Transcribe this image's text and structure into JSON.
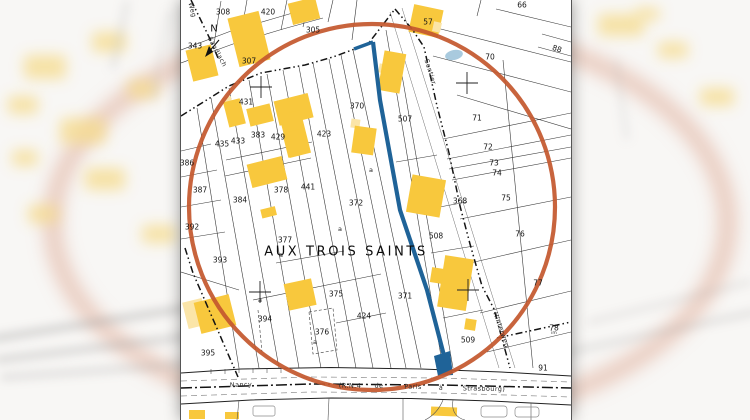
{
  "map": {
    "title": "AUX TROIS SAINTS",
    "north_label": "N",
    "colors": {
      "highlight": "#c4582e",
      "route": "#1f6398",
      "building": "#f8c83d",
      "building_light": "#fbe5a8",
      "pond": "#a9cade",
      "line": "#3a3a3a",
      "paper": "#ffffff"
    },
    "parcel_labels": [
      {
        "text": "308",
        "x": 42,
        "y": 12
      },
      {
        "text": "420",
        "x": 87,
        "y": 12
      },
      {
        "text": "305",
        "x": 132,
        "y": 30
      },
      {
        "text": "57",
        "x": 247,
        "y": 22
      },
      {
        "text": "66",
        "x": 341,
        "y": 5
      },
      {
        "text": "70",
        "x": 309,
        "y": 57
      },
      {
        "text": "88",
        "x": 376,
        "y": 49,
        "rot": 18
      },
      {
        "text": "343",
        "x": 14,
        "y": 46
      },
      {
        "text": "307",
        "x": 68,
        "y": 61
      },
      {
        "text": "431",
        "x": 65,
        "y": 102
      },
      {
        "text": "435",
        "x": 41,
        "y": 144
      },
      {
        "text": "433",
        "x": 57,
        "y": 141
      },
      {
        "text": "383",
        "x": 77,
        "y": 135
      },
      {
        "text": "429",
        "x": 97,
        "y": 137
      },
      {
        "text": "423",
        "x": 143,
        "y": 134
      },
      {
        "text": "370",
        "x": 176,
        "y": 106
      },
      {
        "text": "507",
        "x": 224,
        "y": 119
      },
      {
        "text": "71",
        "x": 296,
        "y": 118
      },
      {
        "text": "72",
        "x": 307,
        "y": 147
      },
      {
        "text": "73",
        "x": 313,
        "y": 163
      },
      {
        "text": "74",
        "x": 316,
        "y": 173
      },
      {
        "text": "75",
        "x": 325,
        "y": 198
      },
      {
        "text": "76",
        "x": 339,
        "y": 234
      },
      {
        "text": "77",
        "x": 357,
        "y": 283
      },
      {
        "text": "78",
        "x": 373,
        "y": 328
      },
      {
        "text": "91",
        "x": 362,
        "y": 368
      },
      {
        "text": "386",
        "x": 6,
        "y": 163
      },
      {
        "text": "387",
        "x": 19,
        "y": 190
      },
      {
        "text": "384",
        "x": 59,
        "y": 200
      },
      {
        "text": "378",
        "x": 100,
        "y": 190
      },
      {
        "text": "441",
        "x": 127,
        "y": 187
      },
      {
        "text": "372",
        "x": 175,
        "y": 203
      },
      {
        "text": "392",
        "x": 11,
        "y": 227
      },
      {
        "text": "377",
        "x": 104,
        "y": 240
      },
      {
        "text": "393",
        "x": 39,
        "y": 260
      },
      {
        "text": "368",
        "x": 279,
        "y": 201
      },
      {
        "text": "508",
        "x": 255,
        "y": 236
      },
      {
        "text": "371",
        "x": 224,
        "y": 296
      },
      {
        "text": "375",
        "x": 155,
        "y": 294
      },
      {
        "text": "424",
        "x": 183,
        "y": 316
      },
      {
        "text": "394",
        "x": 84,
        "y": 319
      },
      {
        "text": "376",
        "x": 141,
        "y": 332
      },
      {
        "text": "395",
        "x": 27,
        "y": 353
      },
      {
        "text": "509",
        "x": 287,
        "y": 340
      }
    ],
    "letter_labels": [
      {
        "text": "a",
        "x": 190,
        "y": 170
      },
      {
        "text": "a",
        "x": 159,
        "y": 229
      },
      {
        "text": "a",
        "x": 100,
        "y": 255
      },
      {
        "text": "a",
        "x": 134,
        "y": 342
      },
      {
        "text": "a",
        "x": 79,
        "y": 300
      }
    ],
    "street_labels": [
      {
        "text": "Sentier",
        "x": 249,
        "y": 72,
        "rot": 73
      },
      {
        "text": "Hinterweg",
        "x": 320,
        "y": 330,
        "rot": 71
      },
      {
        "text": "Nancy",
        "x": 60,
        "y": 385,
        "rot": -2
      },
      {
        "text": "(R.N.4",
        "x": 169,
        "y": 386,
        "rot": 1
      },
      {
        "text": "de",
        "x": 198,
        "y": 386,
        "rot": 1
      },
      {
        "text": "Paris",
        "x": 232,
        "y": 387,
        "rot": 1
      },
      {
        "text": "à",
        "x": 260,
        "y": 388,
        "rot": 1
      },
      {
        "text": "Strasbourg)",
        "x": 303,
        "y": 389,
        "rot": 1
      },
      {
        "text": "Weg",
        "x": 11,
        "y": 10,
        "rot": 75
      },
      {
        "text": "Sandlach",
        "x": 36,
        "y": 52,
        "rot": 62
      }
    ],
    "tiny_labels": [
      {
        "text": "im",
        "x": 373,
        "y": 334
      }
    ]
  }
}
